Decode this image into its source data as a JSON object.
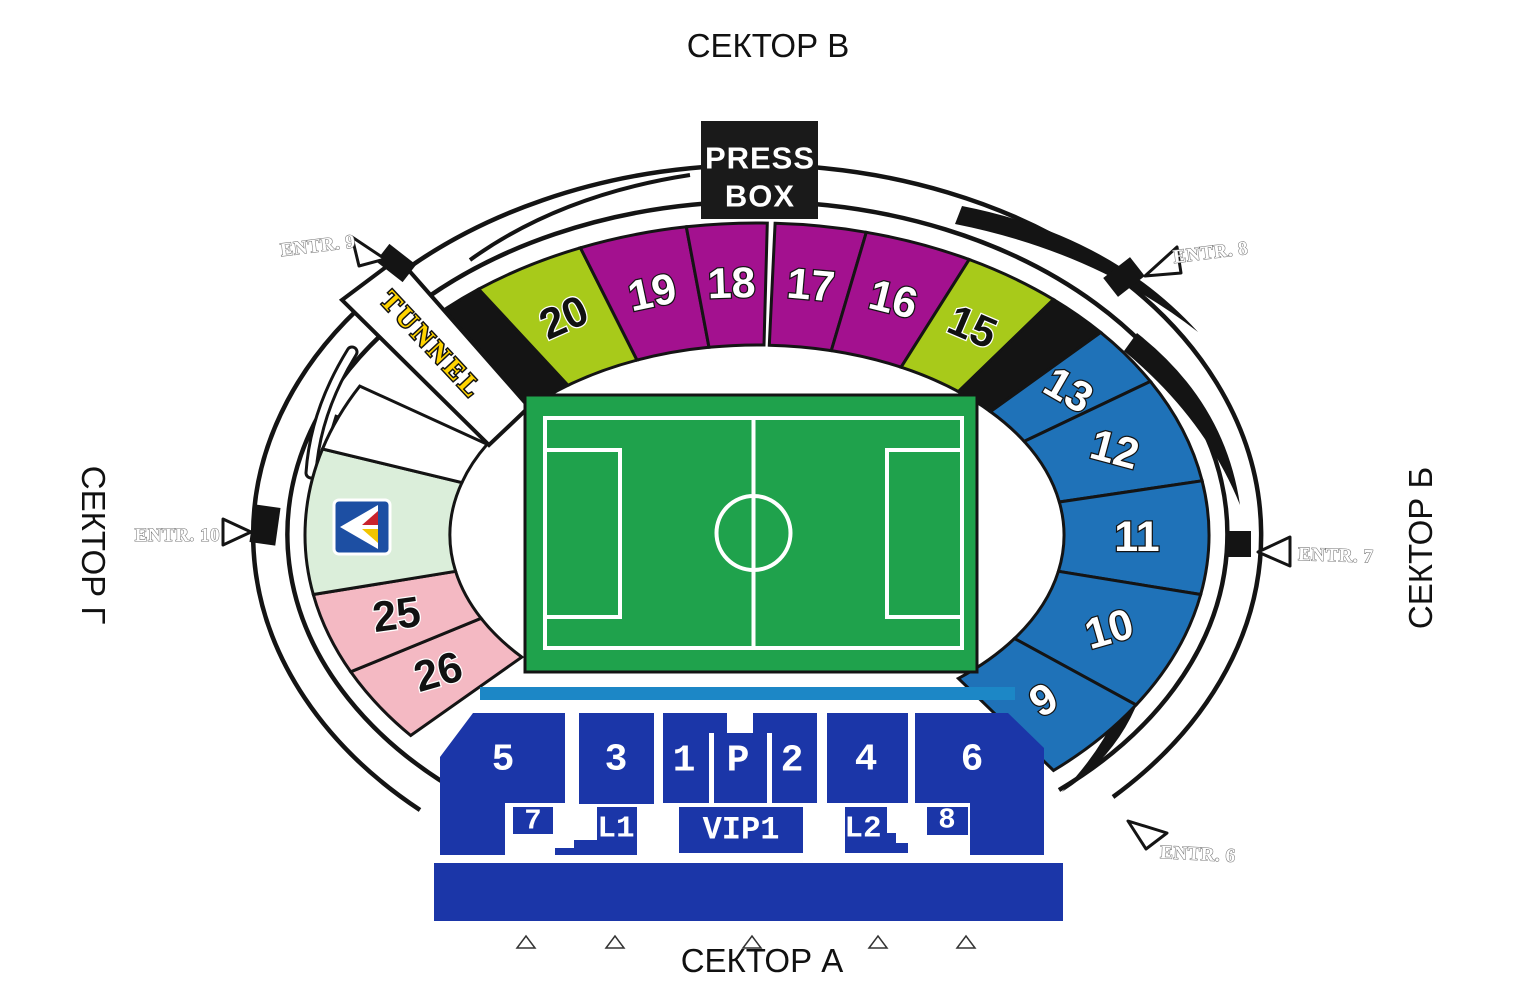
{
  "titles": {
    "top": "СЕКТОР В",
    "bottom": "СЕКТОР А",
    "left": "СЕКТОР Г",
    "right": "СЕКТОР Б"
  },
  "press_box": {
    "line1": "PRESS",
    "line2": "BOX"
  },
  "tunnel_label": "TUNNEL",
  "entrances": {
    "e6": "ENTR. 6",
    "e7": "ENTR. 7",
    "e8": "ENTR. 8",
    "e9": "ENTR. 9",
    "e10": "ENTR. 10"
  },
  "colors": {
    "magenta": "#A3118F",
    "lime": "#A8CA1A",
    "blue": "#1F72B8",
    "black_section": "#141414",
    "pink": "#F4B9C3",
    "light_green": "#DBEEDA",
    "white_section": "#FFFFFF",
    "field_green": "#1FA24C",
    "stand_blue": "#1B36A8",
    "strip_blue": "#1C87C6",
    "tunnel_yellow": "#FFD400",
    "outline": "#141414",
    "logo_blue": "#1D4FA3",
    "logo_red": "#C8232E",
    "logo_yellow": "#F2C500"
  },
  "bowl": {
    "cx": 757,
    "cy": 535,
    "inner_rx": 307,
    "inner_ry": 190,
    "outer_rx": 452,
    "outer_ry": 312,
    "label_rx": 380,
    "label_ry": 252,
    "sections": [
      {
        "label": "26",
        "color": "pink",
        "start": 206,
        "end": 220,
        "rot": -16,
        "label_style": "dark"
      },
      {
        "label": "25",
        "color": "pink",
        "start": 191,
        "end": 206,
        "rot": -8,
        "label_style": "dark"
      },
      {
        "label": "",
        "color": "light_green",
        "start": 164,
        "end": 191
      },
      {
        "label": "",
        "color": "white_section",
        "start": 151.5,
        "end": 164
      },
      {
        "label": "",
        "color": "black_section",
        "start": 128,
        "end": 138.5
      },
      {
        "label": "20",
        "color": "lime",
        "start": 113,
        "end": 128,
        "rot": -24,
        "label_style": "dark"
      },
      {
        "label": "19",
        "color": "magenta",
        "start": 99,
        "end": 113,
        "rot": -12,
        "label_style": "light"
      },
      {
        "label": "18",
        "color": "magenta",
        "start": 88.7,
        "end": 99,
        "rot": -2,
        "label_style": "light"
      },
      {
        "label": "17",
        "color": "magenta",
        "start": 76,
        "end": 87.7,
        "rot": 5,
        "label_style": "light"
      },
      {
        "label": "16",
        "color": "magenta",
        "start": 62,
        "end": 76,
        "rot": 14,
        "label_style": "light"
      },
      {
        "label": "15",
        "color": "lime",
        "start": 49,
        "end": 62,
        "rot": 23,
        "label_style": "dark"
      },
      {
        "label": "",
        "color": "black_section",
        "start": 40.5,
        "end": 49
      },
      {
        "label": "13",
        "color": "blue",
        "start": 29.5,
        "end": 40.5,
        "rot": 30,
        "label_style": "light"
      },
      {
        "label": "12",
        "color": "blue",
        "start": 10,
        "end": 29.5,
        "rot": 15,
        "label_style": "light"
      },
      {
        "label": "11",
        "color": "blue",
        "start": -11,
        "end": 10,
        "rot": 0,
        "label_style": "light"
      },
      {
        "label": "10",
        "color": "blue",
        "start": -33,
        "end": -11,
        "rot": -16,
        "label_style": "light"
      },
      {
        "label": "9",
        "color": "blue",
        "start": -49,
        "end": -33,
        "rot": -30,
        "label_style": "light"
      }
    ]
  },
  "bottom_stand": {
    "s5": "5",
    "s3": "3",
    "s1": "1",
    "sp": "P",
    "s2": "2",
    "s4": "4",
    "s6": "6",
    "s7": "7",
    "l1": "L1",
    "vip": "VIP1",
    "l2": "L2",
    "s8": "8"
  }
}
